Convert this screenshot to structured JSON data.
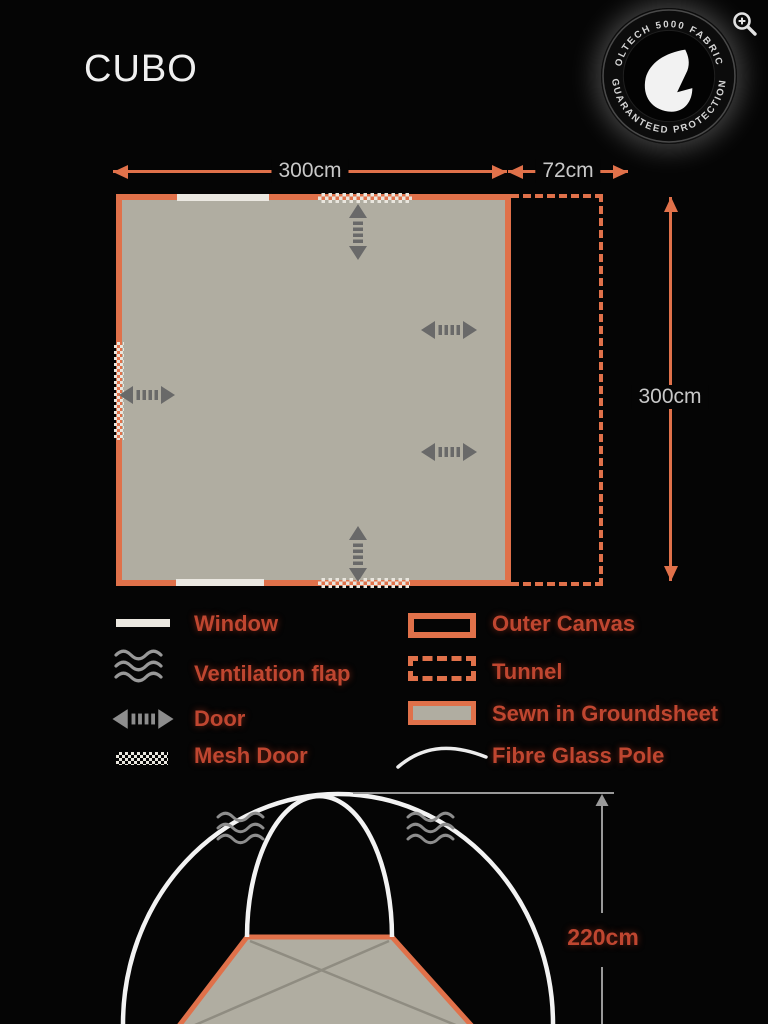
{
  "title": "CUBO",
  "viewer": {
    "zoom_icon": "zoom-in-icon"
  },
  "badge": {
    "top_text": "OLTECH 5000 FABRIC",
    "bottom_text": "GUARANTEED PROTECTION",
    "icon": "water-drop-icon"
  },
  "floorplan": {
    "width_label": "300cm",
    "tunnel_width_label": "72cm",
    "depth_label": "300cm",
    "features": {
      "windows": 2,
      "mesh_doors": 3,
      "doors": 5,
      "tunnel": 1
    }
  },
  "sideview": {
    "height_label": "220cm",
    "ventilation_flaps": 2
  },
  "legend": {
    "left": [
      {
        "label": "Window",
        "icon": "window-icon"
      },
      {
        "label": "Ventilation flap",
        "icon": "ventilation-flap-icon"
      },
      {
        "label": "Door",
        "icon": "door-icon"
      },
      {
        "label": "Mesh Door",
        "icon": "mesh-door-icon"
      }
    ],
    "right": [
      {
        "label": "Outer Canvas",
        "icon": "outer-canvas-icon"
      },
      {
        "label": "Tunnel",
        "icon": "tunnel-icon"
      },
      {
        "label": "Sewn in Groundsheet",
        "icon": "groundsheet-icon"
      },
      {
        "label": "Fibre Glass Pole",
        "icon": "fibreglass-pole-icon"
      }
    ]
  },
  "colors": {
    "background": "#050505",
    "canvas_orange": "#e0714a",
    "label_red": "#bf4630",
    "dimension_grey": "#c8c8c8",
    "groundsheet_grey": "#b0ada1",
    "door_arrow_grey": "#696969",
    "pole_white": "#f3f3f3"
  }
}
